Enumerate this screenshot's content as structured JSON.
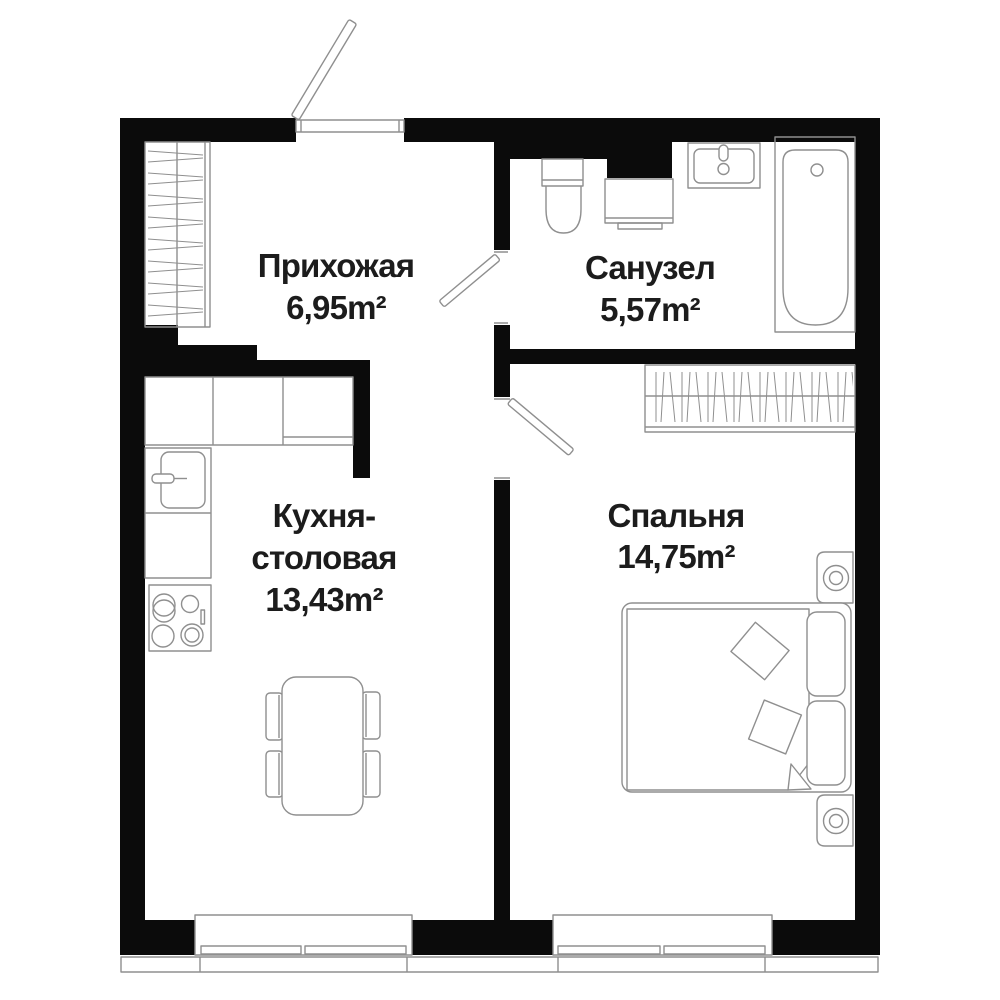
{
  "plan": {
    "title": "apartment-floor-plan",
    "colors": {
      "wall": "#0b0b0b",
      "line": "#8f8f8f",
      "text": "#1c1c1c",
      "bg": "#ffffff"
    },
    "rooms": {
      "hallway": {
        "name": "Прихожая",
        "area": "6,95m²"
      },
      "bathroom": {
        "name": "Санузел",
        "area": "5,57m²"
      },
      "kitchen": {
        "name_line1": "Кухня-",
        "name_line2": "столовая",
        "area": "13,43m²"
      },
      "bedroom": {
        "name": "Спальня",
        "area": "14,75m²"
      }
    }
  }
}
